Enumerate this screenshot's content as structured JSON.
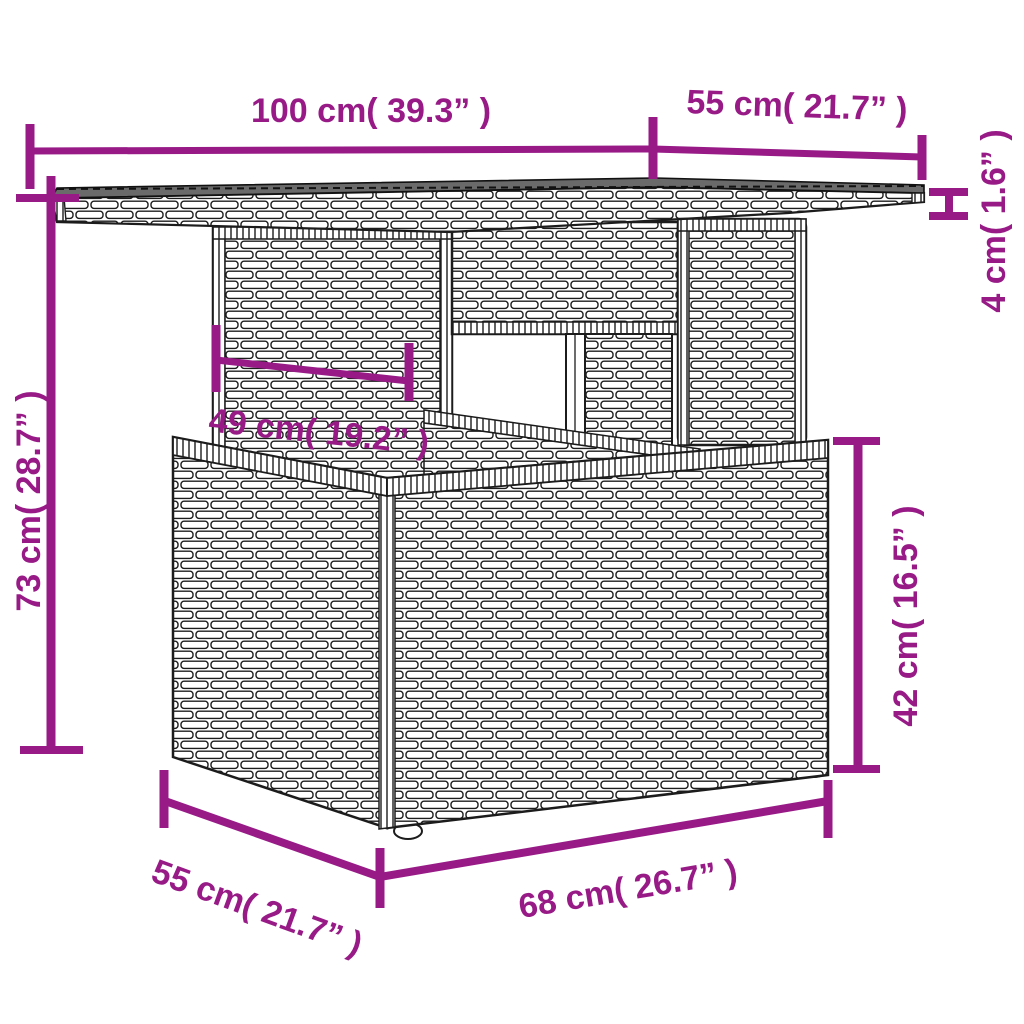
{
  "meta": {
    "background": "#ffffff",
    "accent_color": "#971A87",
    "line_art_color": "#1c1c1c",
    "tabletop_surface_color": "#6a6a6a"
  },
  "diagram": {
    "kind": "furniture-dimension-line-drawing",
    "subject": "poly rattan garden table with glass top, pedestal and storage base, drawn in wicker line art",
    "dimensions": [
      {
        "id": "tabletop-length",
        "label": "100 cm( 39.3” )",
        "placement": "top, horizontal"
      },
      {
        "id": "tabletop-depth",
        "label": "55 cm( 21.7” )",
        "placement": "top-right, horizontal"
      },
      {
        "id": "tabletop-thickness",
        "label": "4 cm( 1.6” )",
        "placement": "right edge, vertical"
      },
      {
        "id": "overall-height",
        "label": "73 cm( 28.7” )",
        "placement": "left side, vertical"
      },
      {
        "id": "pedestal-width",
        "label": "49 cm( 19.2” )",
        "placement": "center, slanted"
      },
      {
        "id": "base-height",
        "label": "42 cm( 16.5” )",
        "placement": "right side, vertical"
      },
      {
        "id": "base-depth",
        "label": "55 cm( 21.7” )",
        "placement": "bottom-left, slanted"
      },
      {
        "id": "base-length",
        "label": "68 cm( 26.7” )",
        "placement": "bottom, slanted"
      }
    ]
  }
}
